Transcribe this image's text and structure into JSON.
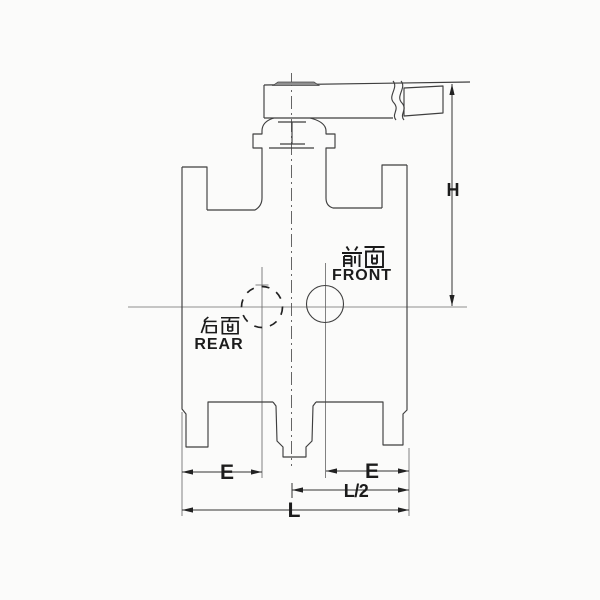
{
  "diagram": {
    "annotations": {
      "front_label_cn": "前面",
      "front_label_en": "FRONT",
      "rear_label_cn": "后面",
      "rear_label_en": "REAR"
    },
    "dimensions": {
      "height_label": "H",
      "left_end_label": "E",
      "right_end_label": "E",
      "half_length_label": "L/2",
      "length_label": "L"
    },
    "colors": {
      "background": "#fbfbfa",
      "line": "#3f3f3f",
      "text": "#1c1c1c"
    }
  }
}
